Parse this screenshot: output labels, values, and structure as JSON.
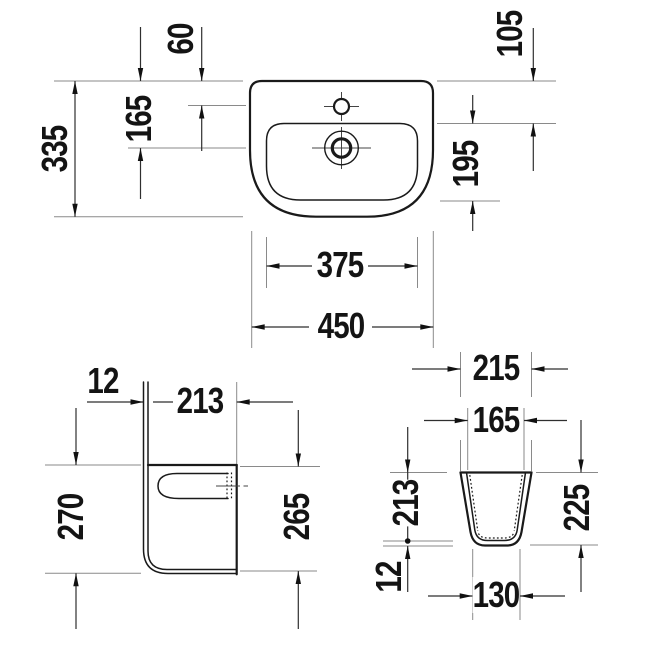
{
  "title": "Washbasin with semi-pedestal dimension drawing",
  "views": {
    "washbasin_top": {
      "label": "washbasin top view",
      "dims": {
        "tap_hole_offset": "60",
        "drain_center_offset": "165",
        "overall_depth": "335",
        "rim_to_bowl": "105",
        "bowl_depth": "195",
        "bowl_width": "375",
        "overall_width": "450"
      }
    },
    "pedestal_side": {
      "label": "semi-pedestal side view",
      "dims": {
        "wall_gap": "12",
        "depth": "213",
        "back_height": "270",
        "front_height": "265"
      }
    },
    "pedestal_front": {
      "label": "semi-pedestal front view",
      "dims": {
        "top_width": "215",
        "inner_top_width": "165",
        "body_height": "213",
        "foot_height": "12",
        "overall_height": "225",
        "bottom_width": "130"
      }
    }
  },
  "colors": {
    "outline": "#1a1a1a",
    "dimension_line": "#2f2f2f",
    "extension_line": "#8a8a8a",
    "text": "#141414",
    "background": "#ffffff"
  }
}
